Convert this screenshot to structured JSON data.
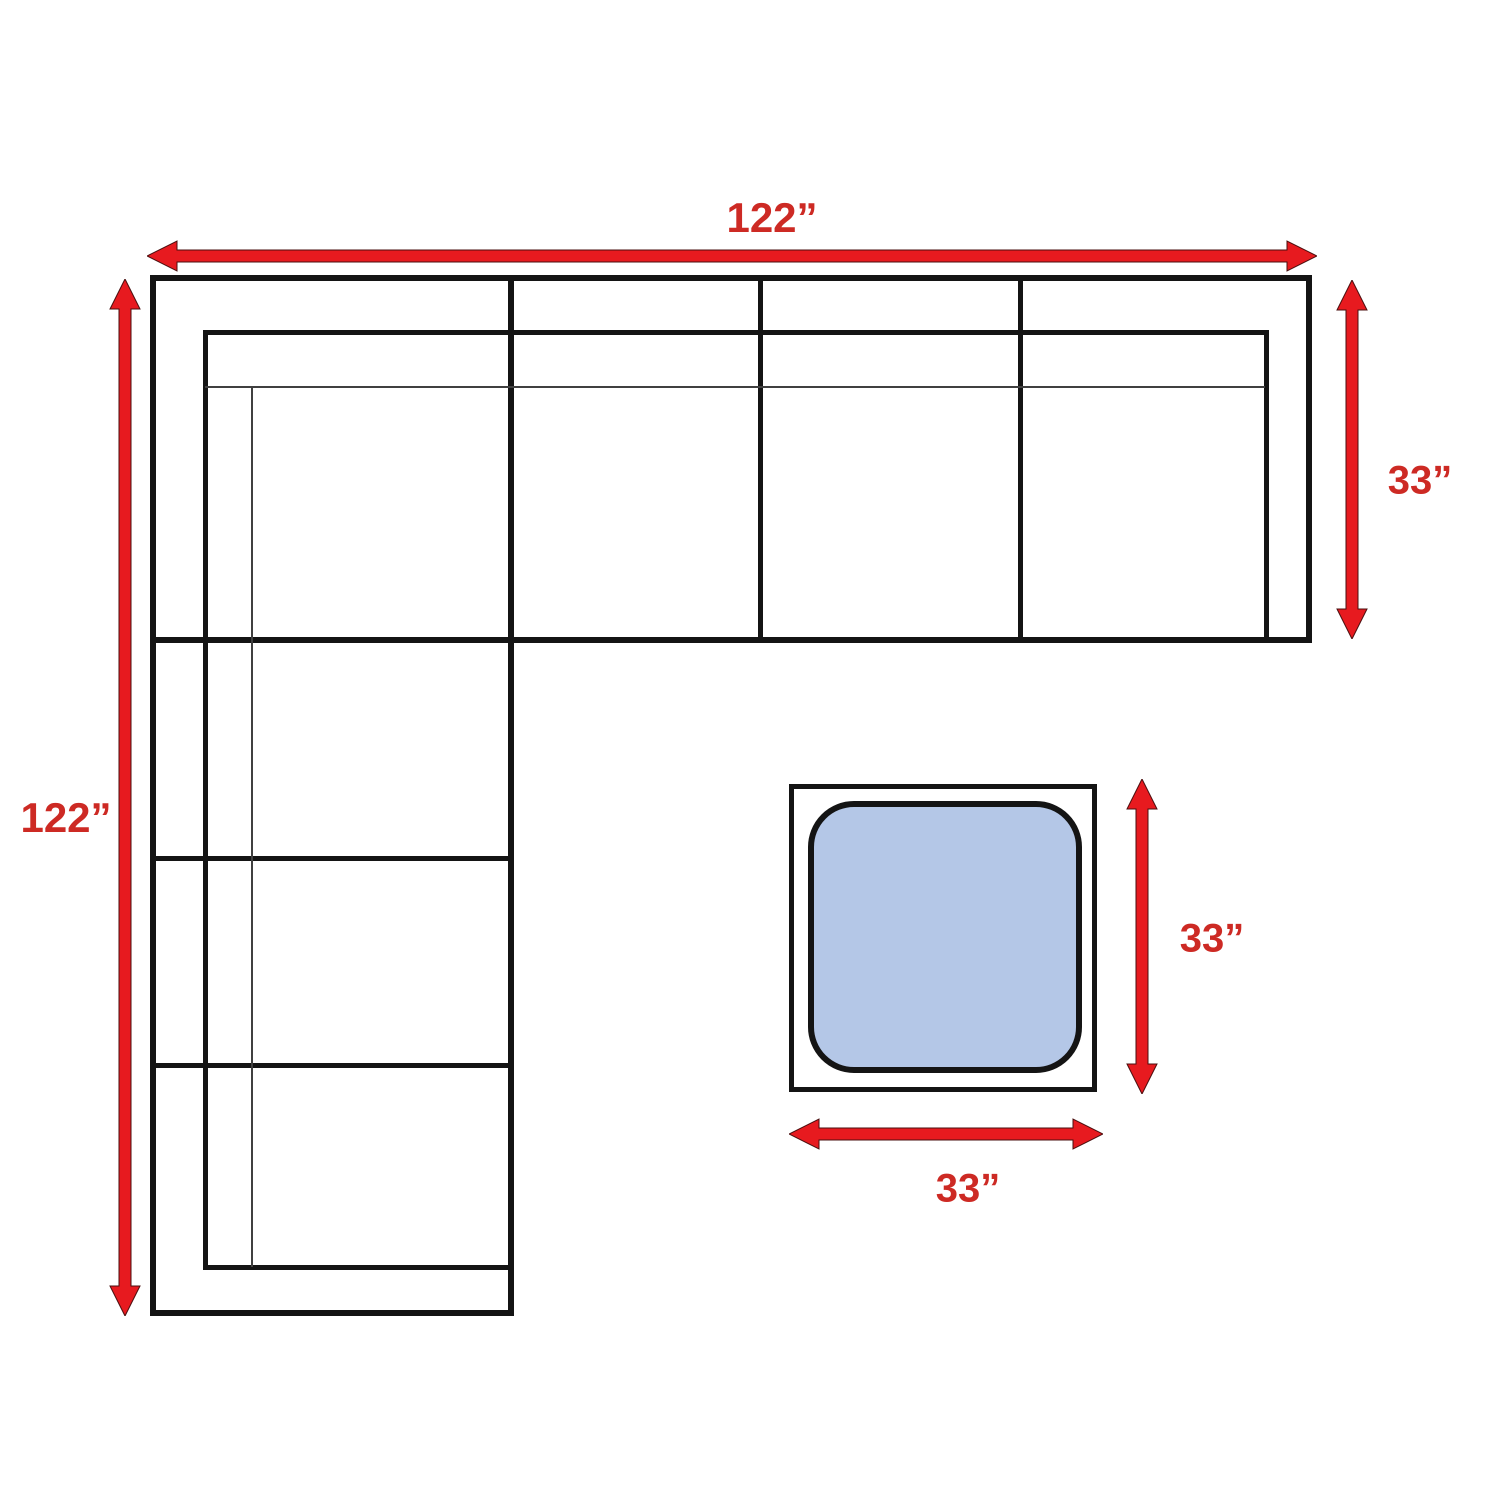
{
  "page": {
    "background": "#ffffff"
  },
  "colors": {
    "arrow_red": "#e71a1f",
    "label_red": "#cd2a24",
    "outline": "#141414",
    "ottoman_fill": "#b4c7e7"
  },
  "sectional": {
    "width_label": "122”",
    "length_label": "122”",
    "depth_label": "33”"
  },
  "ottoman": {
    "height_label": "33”",
    "width_label": "33”"
  }
}
